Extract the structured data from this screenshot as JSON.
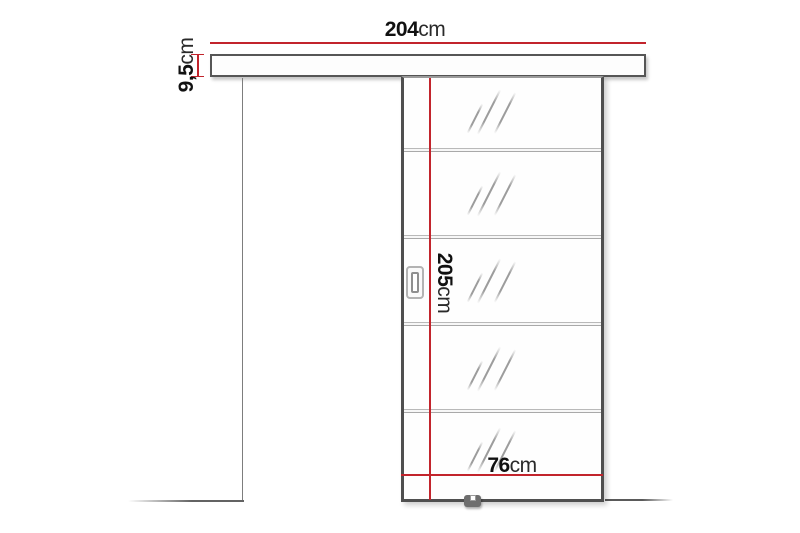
{
  "diagram": {
    "kind": "sliding-door-dimension-diagram",
    "background": "#ffffff",
    "accent_red": "#c2242c",
    "outline_gray": "#4f4f4f",
    "glass_sections": 5,
    "labels": {
      "track_width": {
        "value": "204",
        "unit": "cm"
      },
      "track_height": {
        "value": "9,5",
        "unit": "cm"
      },
      "door_height": {
        "value": "205",
        "unit": "cm"
      },
      "door_width": {
        "value": "76",
        "unit": "cm"
      }
    }
  }
}
